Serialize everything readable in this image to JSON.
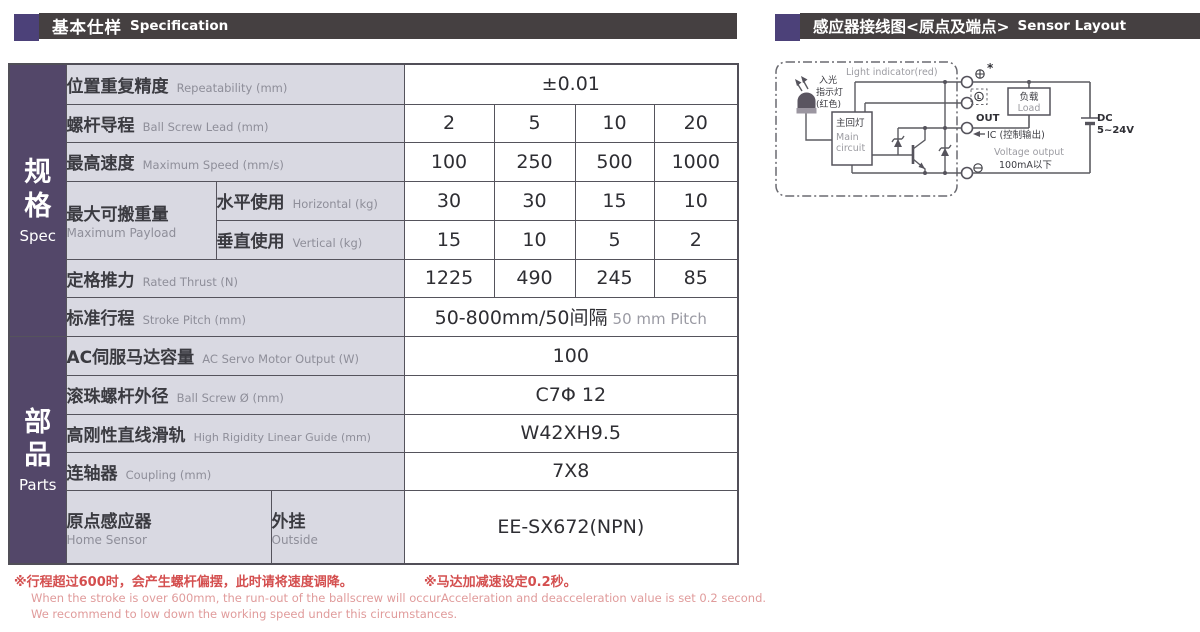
{
  "colors": {
    "sidebar_purple": "#534769",
    "accent_square_purple": "#4c4179",
    "header_bar": "#454041",
    "label_cell_bg": "#d9d9e2",
    "table_border": "#55535c",
    "note_red": "#d44f4f",
    "note_red_light": "#e09b9b"
  },
  "header_left": {
    "title_cn": "基本仕样",
    "title_en": "Specification"
  },
  "header_right": {
    "title_cn": "感应器接线图<原点及端点>",
    "title_en": "Sensor Layout"
  },
  "table": {
    "side_spec": {
      "cn": "规格",
      "en": "Spec"
    },
    "side_parts": {
      "cn": "部品",
      "en": "Parts"
    },
    "repeatability": {
      "cn": "位置重复精度",
      "en": "Repeatability (mm)",
      "value": "±0.01"
    },
    "lead": {
      "cn": "螺杆导程",
      "en": "Ball Screw Lead (mm)",
      "values": [
        "2",
        "5",
        "10",
        "20"
      ]
    },
    "speed": {
      "cn": "最高速度",
      "en": "Maximum Speed (mm/s)",
      "values": [
        "100",
        "250",
        "500",
        "1000"
      ]
    },
    "payload": {
      "cn": "最大可搬重量",
      "en": "Maximum Payload",
      "horizontal": {
        "cn": "水平使用",
        "en": "Horizontal (kg)",
        "values": [
          "30",
          "30",
          "15",
          "10"
        ]
      },
      "vertical": {
        "cn": "垂直使用",
        "en": "Vertical (kg)",
        "values": [
          "15",
          "10",
          "5",
          "2"
        ]
      }
    },
    "thrust": {
      "cn": "定格推力",
      "en": "Rated Thrust (N)",
      "values": [
        "1225",
        "490",
        "245",
        "85"
      ]
    },
    "stroke": {
      "cn": "标准行程",
      "en": "Stroke Pitch (mm)",
      "value_main": "50-800mm/50间隔",
      "value_sub": "50 mm Pitch"
    },
    "motor": {
      "cn": "AC伺服马达容量",
      "en": "AC Servo Motor Output (W)",
      "value": "100"
    },
    "screw_dia": {
      "cn": "滚珠螺杆外径",
      "en": "Ball Screw Ø (mm)",
      "value": "C7Φ 12"
    },
    "guide": {
      "cn": "高刚性直线滑轨",
      "en": "High Rigidity Linear Guide (mm)",
      "value": "W42XH9.5"
    },
    "coupling": {
      "cn": "连轴器",
      "en": "Coupling (mm)",
      "value": "7X8"
    },
    "home_sensor": {
      "cn": "原点感应器",
      "en": "Home Sensor",
      "outside_cn": "外挂",
      "outside_en": "Outside",
      "value": "EE-SX672(NPN)"
    }
  },
  "diagram": {
    "light_indicator": "Light indicator(red)",
    "led_label_l1": "入光",
    "led_label_l2": "指示灯",
    "led_label_l3": "(红色)",
    "main_circuit_cn": "主回灯",
    "main_circuit_en_l1": "Main",
    "main_circuit_en_l2": "circuit",
    "asterisk": "*",
    "terminal_l": "L",
    "terminal_out": "OUT",
    "ic_label": "IC (控制输出)",
    "voltage_output": "Voltage output",
    "current_limit": "100mA以下",
    "load_cn": "负载",
    "load_en": "Load",
    "dc_l1": "DC",
    "dc_l2": "5~24V"
  },
  "notes": {
    "left": {
      "cn": "※行程超过600时，会产生螺杆偏摆，此时请将速度调降。",
      "en1": "When the stroke is over 600mm, the run-out of the ballscrew will occur.",
      "en2": "We recommend to low down the working speed under this circumstances."
    },
    "right": {
      "cn": "※马达加减速设定0.2秒。",
      "en": "Acceleration and deacceleration value is set 0.2 second."
    }
  }
}
